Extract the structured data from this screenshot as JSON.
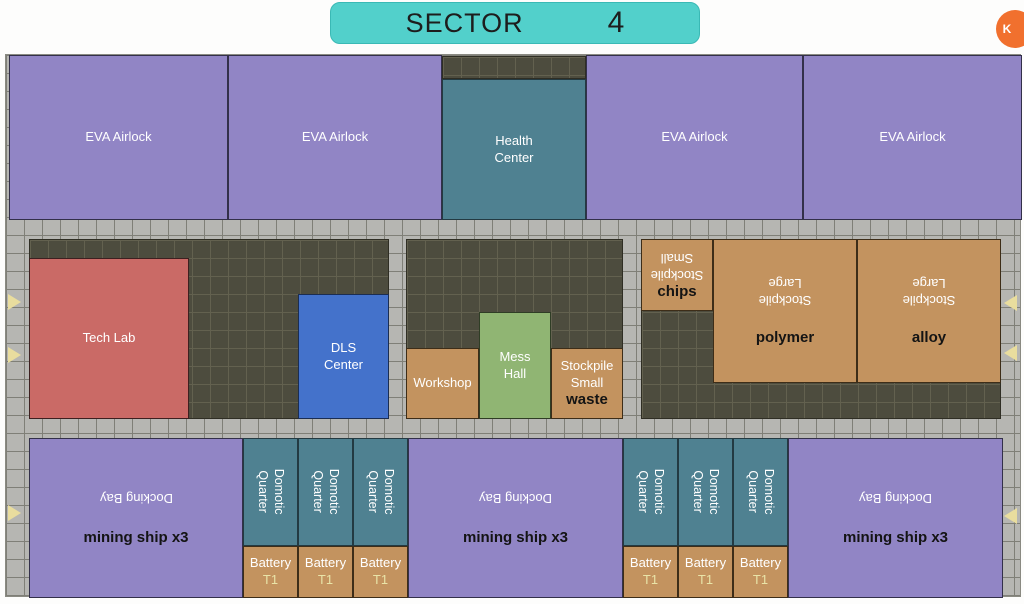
{
  "header": {
    "title": "SECTOR",
    "sector_number": "4"
  },
  "fab": {
    "label": "K"
  },
  "top_band": {
    "eva_airlocks": [
      {
        "label": "EVA Airlock"
      },
      {
        "label": "EVA Airlock"
      },
      {
        "label": "EVA Airlock"
      },
      {
        "label": "EVA Airlock"
      }
    ],
    "health_center": {
      "label": "Health Center"
    }
  },
  "middle_band": {
    "tech_lab": {
      "label": "Tech Lab"
    },
    "dls_center": {
      "label": "DLS Center"
    },
    "workshop": {
      "label": "Workshop"
    },
    "mess_hall": {
      "label": "Mess Hall"
    },
    "stockpile_waste": {
      "label": "Stockpile Small",
      "resource": "waste"
    },
    "stockpile_chips": {
      "label": "Stockpile Small",
      "resource": "chips"
    },
    "stockpile_polymer": {
      "label": "Stockpile Large",
      "resource": "polymer"
    },
    "stockpile_alloy": {
      "label": "Stockpile Large",
      "resource": "alloy"
    }
  },
  "bottom_band": {
    "docking_bays": [
      {
        "label": "Docking Bay",
        "cargo": "mining ship x3"
      },
      {
        "label": "Docking Bay",
        "cargo": "mining ship x3"
      },
      {
        "label": "Docking Bay",
        "cargo": "mining ship x3"
      }
    ],
    "domotic_quarters": [
      {
        "label": "Domotic Quarter"
      },
      {
        "label": "Domotic Quarter"
      },
      {
        "label": "Domotic Quarter"
      },
      {
        "label": "Domotic Quarter"
      },
      {
        "label": "Domotic Quarter"
      },
      {
        "label": "Domotic Quarter"
      }
    ],
    "batteries": [
      {
        "name": "Battery",
        "tier": "T1"
      },
      {
        "name": "Battery",
        "tier": "T1"
      },
      {
        "name": "Battery",
        "tier": "T1"
      },
      {
        "name": "Battery",
        "tier": "T1"
      },
      {
        "name": "Battery",
        "tier": "T1"
      },
      {
        "name": "Battery",
        "tier": "T1"
      }
    ]
  },
  "colors": {
    "header_teal": "#52d0cb",
    "fab_orange": "#f1702e",
    "airlock_purple": "#9185c5",
    "room_teal": "#4f8191",
    "tech_lab_red": "#ca6a66",
    "dls_blue": "#4472cb",
    "stockpile_tan": "#c3935f",
    "mess_green": "#90b573",
    "floor_gray": "#b6b6b2",
    "interior_dark": "#4d4c3e",
    "arrow_cream": "#e9dd9e"
  }
}
